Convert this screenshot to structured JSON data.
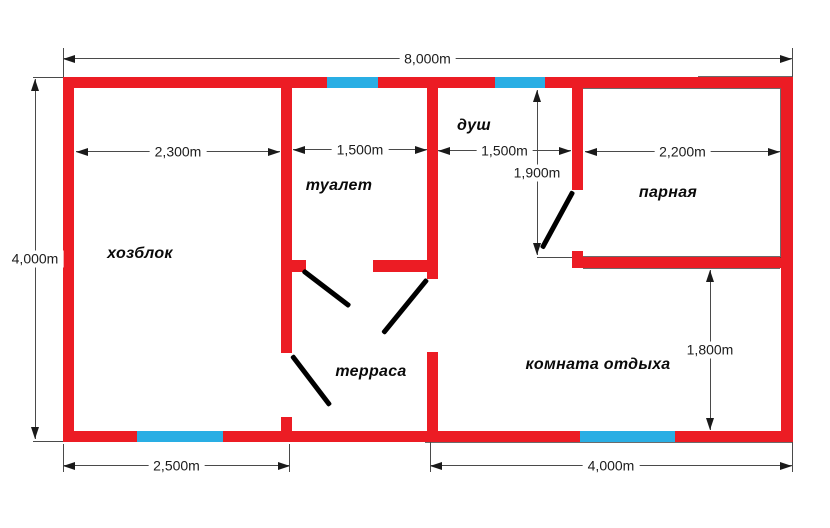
{
  "plan_title": "bath-house floor plan",
  "colors": {
    "wall": "#EC1C24",
    "window": "#29AEE4",
    "door": "#000000",
    "dimension_line": "#4A4A4A",
    "text": "#111111",
    "background": "#FFFFFF"
  },
  "rooms": [
    {
      "id": "khozblok",
      "label": "хозблок"
    },
    {
      "id": "toilet",
      "label": "туалет"
    },
    {
      "id": "shower",
      "label": "душ"
    },
    {
      "id": "parnaya",
      "label": "парная"
    },
    {
      "id": "terrace",
      "label": "терраса"
    },
    {
      "id": "lounge",
      "label": "комната отдыха"
    }
  ],
  "dimensions": {
    "total_width": "8,000m",
    "total_height": "4,000m",
    "khozblok_width": "2,300m",
    "toilet_width": "1,500m",
    "shower_width": "1,500m",
    "parnaya_width": "2,200m",
    "shower_height": "1,900m",
    "lounge_height": "1,800m",
    "left_section_bottom_width": "2,500m",
    "right_section_bottom_width": "4,000m"
  }
}
